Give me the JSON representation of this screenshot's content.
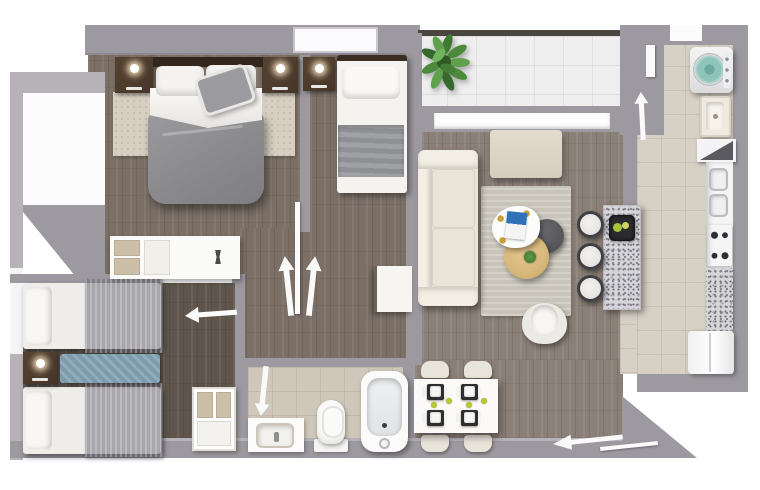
{
  "meta": {
    "description": "Photorealistic 3D top-down floor plan rendering of a three-bedroom apartment; no text labels are rendered in the image",
    "canvas": {
      "width": 760,
      "height": 490
    }
  },
  "rooms": {
    "master_bedroom": {
      "label": "Master bedroom",
      "floor": "dark wood plank",
      "furniture": [
        "double bed with gray duvet",
        "two dark wood nightstands with lamps",
        "beige area rug",
        "dresser with desk and X decor"
      ]
    },
    "second_bedroom": {
      "label": "Second bedroom",
      "floor": "dark wood plank",
      "furniture": [
        "single bed with gray blanket",
        "dark wood nightstand with lamp"
      ]
    },
    "twin_bedroom": {
      "label": "Twin bedroom",
      "floor": "dark wood plank",
      "furniture": [
        "twin bed with gray drape",
        "twin bed with gray drape",
        "shared nightstand with lamp",
        "teal bench runner",
        "open shelf unit"
      ]
    },
    "living_room": {
      "label": "Living room",
      "floor": "gray-brown wood plank",
      "furniture": [
        "cream three-seat sofa",
        "beige ottoman bench",
        "gray area rug",
        "white organic coffee table with magazine",
        "dark round nesting table",
        "wooden round nesting table with small plant",
        "white swivel armchair",
        "white side table"
      ]
    },
    "dining_area": {
      "label": "Dining area",
      "furniture": [
        "white dining table",
        "four cream chairs",
        "four dark place settings with white plates",
        "four limes"
      ]
    },
    "kitchen": {
      "label": "Kitchen",
      "floor": "beige tile",
      "furniture": [
        "granite island breakfast bar with fruit tray",
        "three bar stools",
        "double sink",
        "cooktop with four burners",
        "granite counter section",
        "refrigerator"
      ]
    },
    "laundry": {
      "label": "Laundry",
      "floor": "beige tile",
      "furniture": [
        "top-load washing machine with teal lid",
        "laundry sink",
        "dark corner shelf"
      ]
    },
    "bathroom": {
      "label": "Bathroom",
      "floor": "beige tile",
      "furniture": [
        "vanity sink",
        "toilet",
        "bathtub"
      ]
    },
    "balcony": {
      "label": "Balcony",
      "floor": "white tile grid",
      "furniture": [
        "green potted plant"
      ]
    },
    "hallway": {
      "label": "Hallway"
    },
    "entry": {
      "label": "Entry"
    }
  },
  "door_swings": [
    "double doors to master and second bedroom (two up arrows with door leaf)",
    "twin bedroom door (left arrow)",
    "bathroom door (down arrow)",
    "laundry door (up arrow with door leaf)",
    "entry door (long left arrow with door leaf)"
  ],
  "palette": {
    "bg": "#ffffff",
    "wall": "#9d99a0",
    "wallLight": "#b6b2b8",
    "railDark": "#4a463f",
    "woodA": "#7b6f66",
    "woodB": "#8b8077",
    "woodC": "#5f554c",
    "tile": "#d7d0c5",
    "tileBath": "#cfc7b9",
    "balconyTile": "#eeeeef",
    "rugBeige": "#d7d0c2",
    "rugGray": "#c8c4b9",
    "cream": "#e9e4d8",
    "creamLight": "#f2eee4",
    "woodDark": "#46362a",
    "headboard": "#33271d",
    "duvet": "#8d8d90",
    "linen": "#f5f3f0",
    "tealWasher": "#8fc4ba",
    "tealRunner": "#7c9cae",
    "granite": "#d6d6da",
    "plantGreen": "#4c8a3c",
    "lime": "#b4c832",
    "magazineBlue": "#2f72b8",
    "tableWood": "#d9b97c",
    "trayDark": "#2b2b2d",
    "arrowWhite": "#fafafa"
  }
}
